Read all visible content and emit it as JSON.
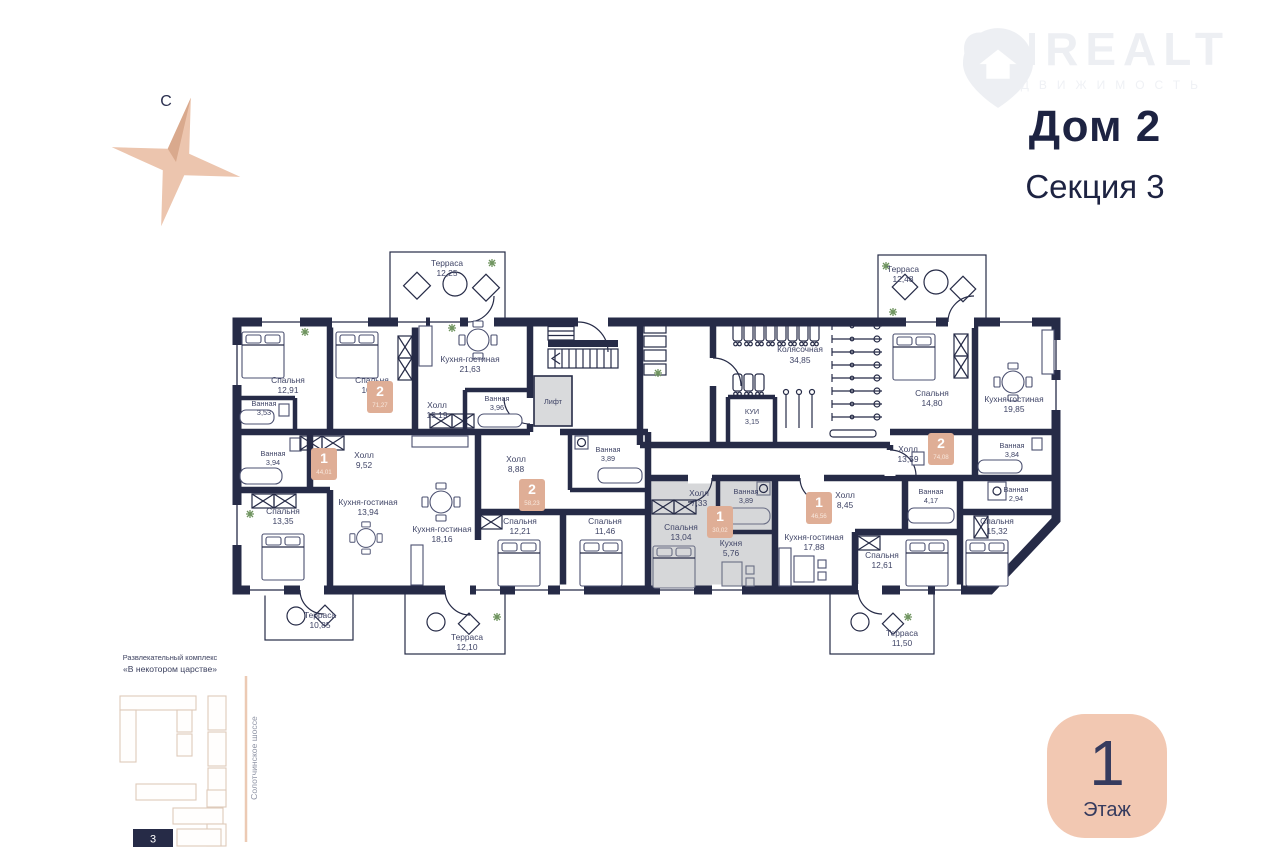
{
  "watermark": {
    "name": "ONREALT",
    "tagline": "НЕДВИЖИМОСТЬ"
  },
  "header": {
    "house": "Дом 2",
    "section": "Секция 3"
  },
  "compass": {
    "north": "С"
  },
  "floor": {
    "number": "1",
    "label": "Этаж"
  },
  "minimap": {
    "complex_label_1": "Развлекательный комплекс",
    "complex_label_2": "«В некотором царстве»",
    "road": "Солотчинское шоссе",
    "section": "3"
  },
  "plan": {
    "common": {
      "lift": "Лифт",
      "stroller_room": {
        "n": "Колясочная",
        "a": "34,85"
      },
      "utility": {
        "n": "КУИ",
        "a": "3,15"
      }
    },
    "apartments": [
      {
        "type": "2",
        "total": "71,27",
        "rooms": [
          {
            "n": "Спальня",
            "a": "12,91"
          },
          {
            "n": "Спальня",
            "a": "10,37"
          },
          {
            "n": "Ванная",
            "a": "3,53"
          },
          {
            "n": "Кухня-гостиная",
            "a": "21,63"
          },
          {
            "n": "Холл",
            "a": "15,19"
          },
          {
            "n": "Ванная",
            "a": "3,96"
          },
          {
            "n": "Терраса",
            "a": "12,25"
          }
        ]
      },
      {
        "type": "2",
        "total": "74,08",
        "rooms": [
          {
            "n": "Спальня",
            "a": "14,80"
          },
          {
            "n": "Кухня-гостиная",
            "a": "19,85"
          },
          {
            "n": "Холл",
            "a": "13,59"
          },
          {
            "n": "Ванная",
            "a": "3,84"
          },
          {
            "n": "Ванная",
            "a": "2,94"
          },
          {
            "n": "Спальня",
            "a": "15,32"
          },
          {
            "n": "Терраса",
            "a": "12,48"
          }
        ]
      },
      {
        "type": "1",
        "total": "44,01",
        "rooms": [
          {
            "n": "Ванная",
            "a": "3,94"
          },
          {
            "n": "Холл",
            "a": "9,52"
          },
          {
            "n": "Спальня",
            "a": "13,35"
          },
          {
            "n": "Кухня-гостиная",
            "a": "13,94"
          },
          {
            "n": "Терраса",
            "a": "10,85"
          }
        ]
      },
      {
        "type": "2",
        "total": "58,23",
        "rooms": [
          {
            "n": "Кухня-гостиная",
            "a": "18,16"
          },
          {
            "n": "Холл",
            "a": "8,88"
          },
          {
            "n": "Ванная",
            "a": "3,89"
          },
          {
            "n": "Спальня",
            "a": "12,21"
          },
          {
            "n": "Спальня",
            "a": "11,46"
          },
          {
            "n": "Терраса",
            "a": "12,10"
          }
        ]
      },
      {
        "type": "1",
        "total": "30,02",
        "rooms": [
          {
            "n": "Холл",
            "a": "7,33"
          },
          {
            "n": "Ванная",
            "a": "3,89"
          },
          {
            "n": "Спальня",
            "a": "13,04"
          },
          {
            "n": "Кухня",
            "a": "5,76"
          }
        ]
      },
      {
        "type": "1",
        "total": "46,56",
        "rooms": [
          {
            "n": "Холл",
            "a": "8,45"
          },
          {
            "n": "Ванная",
            "a": "4,17"
          },
          {
            "n": "Кухня-гостиная",
            "a": "17,88"
          },
          {
            "n": "Спальня",
            "a": "12,61"
          },
          {
            "n": "Терраса",
            "a": "11,50"
          }
        ]
      }
    ]
  },
  "colors": {
    "wall": "#262b47",
    "accent": "#ecc5ae",
    "badge": "#dfae96",
    "selected_flat": "#d6d7d9"
  }
}
